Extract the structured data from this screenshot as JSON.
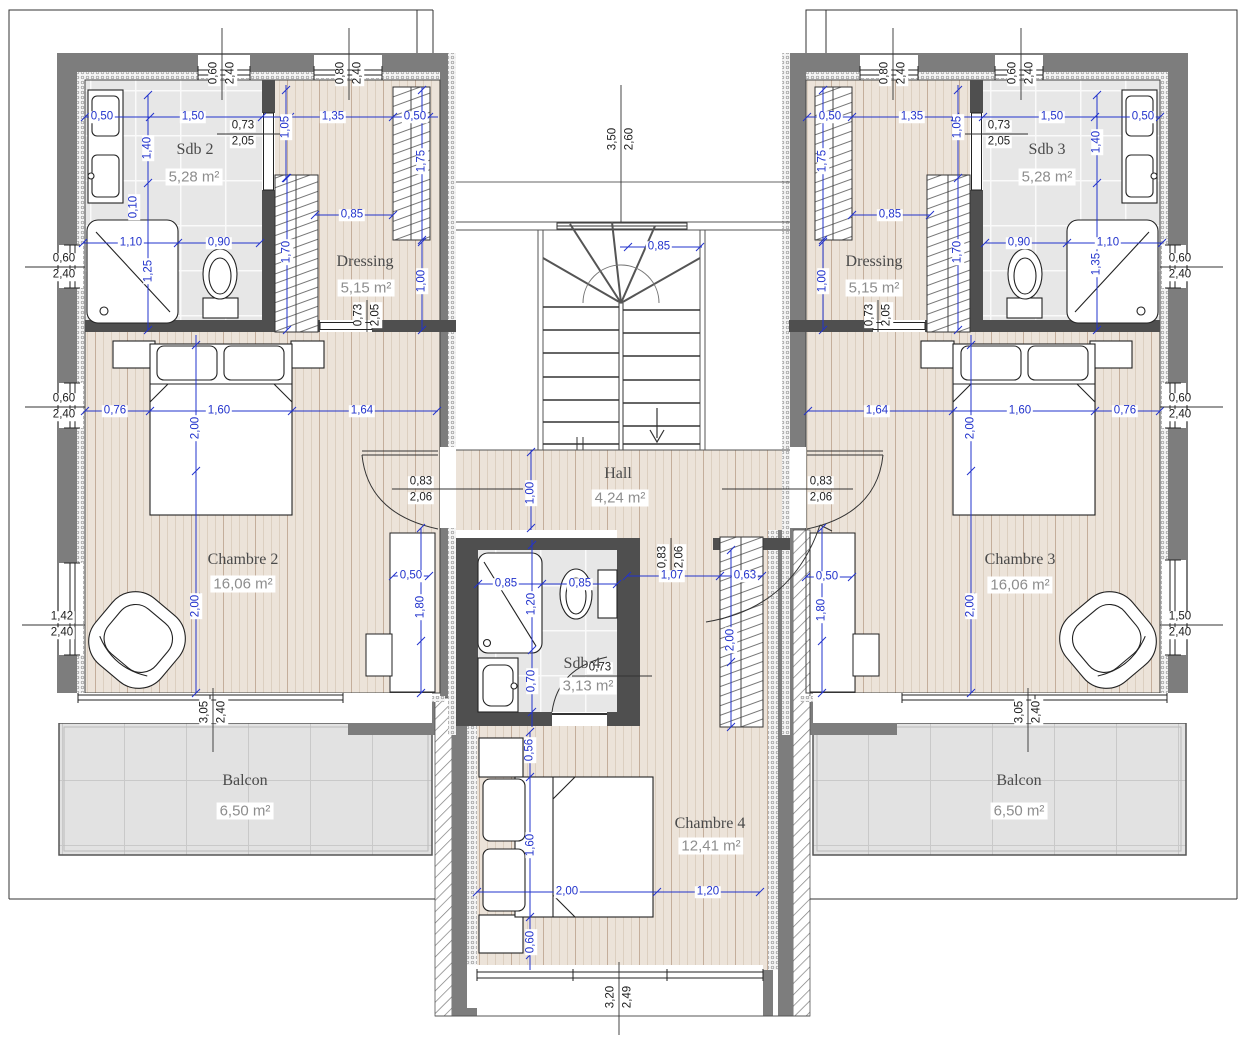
{
  "plan": {
    "title": "Floor plan - upper storey (étage)",
    "rooms": [
      {
        "name": "Sdb 2",
        "area": "5,28 m²",
        "nx": 195,
        "ny": 150,
        "ax": 194,
        "ay": 177
      },
      {
        "name": "Dressing",
        "area": "5,15 m²",
        "nx": 365,
        "ny": 262,
        "ax": 366,
        "ay": 288
      },
      {
        "name": "Sdb 3",
        "area": "5,28 m²",
        "nx": 1047,
        "ny": 150,
        "ax": 1047,
        "ay": 177
      },
      {
        "name": "Dressing",
        "area": "5,15 m²",
        "nx": 874,
        "ny": 262,
        "ax": 874,
        "ay": 288
      },
      {
        "name": "Chambre 2",
        "area": "16,06 m²",
        "nx": 243,
        "ny": 560,
        "ax": 243,
        "ay": 584
      },
      {
        "name": "Chambre 3",
        "area": "16,06 m²",
        "nx": 1020,
        "ny": 560,
        "ax": 1020,
        "ay": 585
      },
      {
        "name": "Hall",
        "area": "4,24 m²",
        "nx": 618,
        "ny": 474,
        "ax": 620,
        "ay": 498
      },
      {
        "name": "Sdb 4",
        "area": "3,13 m²",
        "nx": 582,
        "ny": 664,
        "ax": 588,
        "ay": 686
      },
      {
        "name": "Chambre 4",
        "area": "12,41 m²",
        "nx": 710,
        "ny": 824,
        "ax": 711,
        "ay": 846
      },
      {
        "name": "Balcon",
        "area": "6,50 m²",
        "nx": 245,
        "ny": 781,
        "ax": 245,
        "ay": 811
      },
      {
        "name": "Balcon",
        "area": "6,50 m²",
        "nx": 1019,
        "ny": 781,
        "ax": 1019,
        "ay": 811
      }
    ],
    "dims": [
      {
        "t": "0,50",
        "x": 102,
        "y": 117
      },
      {
        "t": "1,50",
        "x": 193,
        "y": 117
      },
      {
        "t": "1,35",
        "x": 333,
        "y": 117
      },
      {
        "t": "0,50",
        "x": 415,
        "y": 117
      },
      {
        "t": "1,40",
        "x": 148,
        "y": 148,
        "rot": true
      },
      {
        "t": "1,05",
        "x": 286,
        "y": 127,
        "rot": true
      },
      {
        "t": "0,10",
        "x": 134,
        "y": 207,
        "rot": true
      },
      {
        "t": "1,75",
        "x": 422,
        "y": 161,
        "rot": true
      },
      {
        "t": "0,85",
        "x": 352,
        "y": 215
      },
      {
        "t": "1,10",
        "x": 131,
        "y": 243
      },
      {
        "t": "0,90",
        "x": 219,
        "y": 243
      },
      {
        "t": "1,25",
        "x": 149,
        "y": 271,
        "rot": true
      },
      {
        "t": "1,70",
        "x": 287,
        "y": 252,
        "rot": true
      },
      {
        "t": "1,00",
        "x": 422,
        "y": 281,
        "rot": true
      },
      {
        "t": "0,76",
        "x": 115,
        "y": 411
      },
      {
        "t": "1,60",
        "x": 219,
        "y": 411
      },
      {
        "t": "1,64",
        "x": 362,
        "y": 411
      },
      {
        "t": "2,00",
        "x": 196,
        "y": 428,
        "rot": true
      },
      {
        "t": "2,00",
        "x": 196,
        "y": 606,
        "rot": true
      },
      {
        "t": "0,50",
        "x": 411,
        "y": 576
      },
      {
        "t": "1,80",
        "x": 421,
        "y": 607,
        "rot": true
      },
      {
        "t": "0,50",
        "x": 830,
        "y": 117
      },
      {
        "t": "1,35",
        "x": 912,
        "y": 117
      },
      {
        "t": "1,50",
        "x": 1052,
        "y": 117
      },
      {
        "t": "0,50",
        "x": 1143,
        "y": 117
      },
      {
        "t": "1,05",
        "x": 958,
        "y": 127,
        "rot": true
      },
      {
        "t": "1,40",
        "x": 1097,
        "y": 142,
        "rot": true
      },
      {
        "t": "1,75",
        "x": 823,
        "y": 161,
        "rot": true
      },
      {
        "t": "0,85",
        "x": 890,
        "y": 215
      },
      {
        "t": "0,90",
        "x": 1019,
        "y": 243
      },
      {
        "t": "1,10",
        "x": 1108,
        "y": 243
      },
      {
        "t": "1,35",
        "x": 1097,
        "y": 264,
        "rot": true
      },
      {
        "t": "1,70",
        "x": 958,
        "y": 252,
        "rot": true
      },
      {
        "t": "1,00",
        "x": 823,
        "y": 281,
        "rot": true
      },
      {
        "t": "1,64",
        "x": 877,
        "y": 411
      },
      {
        "t": "1,60",
        "x": 1020,
        "y": 411
      },
      {
        "t": "0,76",
        "x": 1125,
        "y": 411
      },
      {
        "t": "2,00",
        "x": 971,
        "y": 428,
        "rot": true
      },
      {
        "t": "2,00",
        "x": 971,
        "y": 606,
        "rot": true
      },
      {
        "t": "0,50",
        "x": 827,
        "y": 577
      },
      {
        "t": "1,80",
        "x": 822,
        "y": 610,
        "rot": true
      },
      {
        "t": "0,85",
        "x": 659,
        "y": 247
      },
      {
        "t": "1,00",
        "x": 531,
        "y": 493,
        "rot": true
      },
      {
        "t": "0,85",
        "x": 506,
        "y": 584
      },
      {
        "t": "0,85",
        "x": 580,
        "y": 584
      },
      {
        "t": "1,20",
        "x": 532,
        "y": 604,
        "rot": true
      },
      {
        "t": "0,70",
        "x": 532,
        "y": 681,
        "rot": true
      },
      {
        "t": "1,07",
        "x": 672,
        "y": 576
      },
      {
        "t": "0,63",
        "x": 745,
        "y": 576
      },
      {
        "t": "2,00",
        "x": 731,
        "y": 640,
        "rot": true
      },
      {
        "t": "0,56",
        "x": 530,
        "y": 750,
        "rot": true
      },
      {
        "t": "1,60",
        "x": 531,
        "y": 845,
        "rot": true
      },
      {
        "t": "0,60",
        "x": 531,
        "y": 942,
        "rot": true
      },
      {
        "t": "2,00",
        "x": 567,
        "y": 892
      },
      {
        "t": "1,20",
        "x": 708,
        "y": 892
      }
    ],
    "sizes": [
      {
        "a": "0,73",
        "b": "2,05",
        "x": 243,
        "y": 134
      },
      {
        "a": "0,73",
        "b": "2,05",
        "x": 999,
        "y": 134
      },
      {
        "a": "0,83",
        "b": "2,06",
        "x": 421,
        "y": 490
      },
      {
        "a": "0,83",
        "b": "2,06",
        "x": 821,
        "y": 490
      },
      {
        "a": "0,73",
        "b": "2,05",
        "x": 600,
        "y": 676
      },
      {
        "a": "0,60",
        "b": "2,40",
        "x": 64,
        "y": 267
      },
      {
        "a": "0,60",
        "b": "2,40",
        "x": 64,
        "y": 407
      },
      {
        "a": "1,42",
        "b": "2,40",
        "x": 62,
        "y": 625
      },
      {
        "a": "0,60",
        "b": "2,40",
        "x": 1180,
        "y": 267
      },
      {
        "a": "0,60",
        "b": "2,40",
        "x": 1180,
        "y": 407
      },
      {
        "a": "1,50",
        "b": "2,40",
        "x": 1180,
        "y": 625
      },
      {
        "a": "0,60",
        "b": "2,40",
        "x": 222,
        "y": 73,
        "rot": true
      },
      {
        "a": "0,80",
        "b": "2,40",
        "x": 349,
        "y": 73,
        "rot": true
      },
      {
        "a": "0,80",
        "b": "2,40",
        "x": 893,
        "y": 73,
        "rot": true
      },
      {
        "a": "0,60",
        "b": "2,40",
        "x": 1021,
        "y": 73,
        "rot": true
      },
      {
        "a": "3,50",
        "b": "2,60",
        "x": 621,
        "y": 139,
        "rot": true
      },
      {
        "a": "0,73",
        "b": "2,05",
        "x": 367,
        "y": 315,
        "rot": true
      },
      {
        "a": "0,73",
        "b": "2,05",
        "x": 878,
        "y": 315,
        "rot": true
      },
      {
        "a": "0,83",
        "b": "2,06",
        "x": 671,
        "y": 557,
        "rot": true
      },
      {
        "a": "3,05",
        "b": "2,40",
        "x": 213,
        "y": 712,
        "rot": true
      },
      {
        "a": "3,05",
        "b": "2,40",
        "x": 1028,
        "y": 712,
        "rot": true
      },
      {
        "a": "3,20",
        "b": "2,49",
        "x": 619,
        "y": 997,
        "rot": true
      }
    ],
    "colors": {
      "dimension_blue": "#2233cc",
      "wall_gray": "#7d7d7d",
      "partition_dark": "#4f4f4f",
      "wood_floor": "#ece3d9",
      "tile_floor": "#e7e7e7",
      "balcony": "#e2e2e2"
    }
  }
}
